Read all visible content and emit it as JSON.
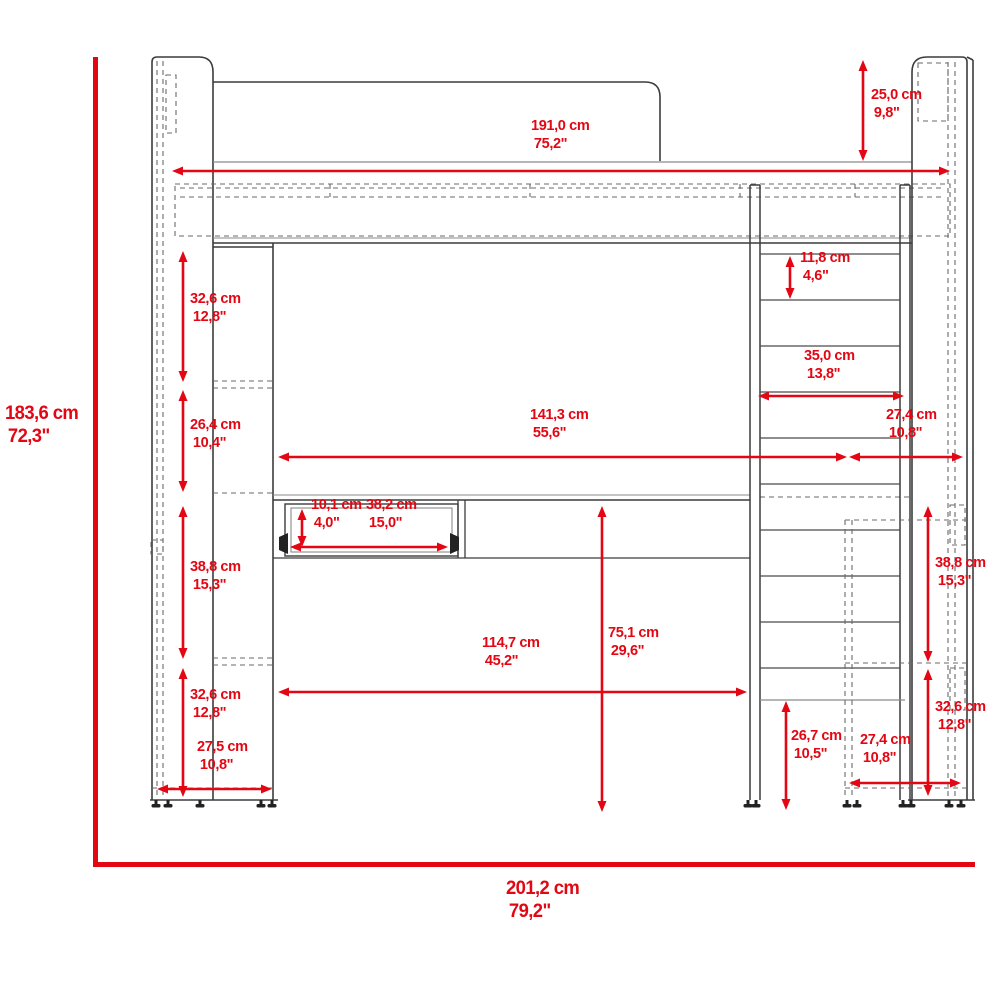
{
  "diagram": {
    "type": "furniture-dimension-drawing",
    "subject": "loft bed with desk, wardrobe tower, drawer and ladder — front elevation",
    "accent_color": "#e30613",
    "line_color": "#3c3c3c",
    "units": [
      "cm",
      "inch"
    ]
  },
  "overall": {
    "height": {
      "cm": "183,6 cm",
      "inch": "72,3\""
    },
    "width": {
      "cm": "201,2 cm",
      "inch": "79,2\""
    }
  },
  "dimensions": {
    "bed_length": {
      "cm": "191,0 cm",
      "inch": "75,2\""
    },
    "headboard_height": {
      "cm": "25,0 cm",
      "inch": "9,8\""
    },
    "ladder_rung_spacing": {
      "cm": "11,8 cm",
      "inch": "4,6\""
    },
    "ladder_width": {
      "cm": "35,0 cm",
      "inch": "13,8\""
    },
    "underbed_clear_width": {
      "cm": "141,3 cm",
      "inch": "55,6\""
    },
    "right_depth_upper": {
      "cm": "27,4 cm",
      "inch": "10,8\""
    },
    "left_shelf_upper": {
      "cm": "32,6 cm",
      "inch": "12,8\""
    },
    "left_shelf_middle": {
      "cm": "26,4 cm",
      "inch": "10,4\""
    },
    "drawer_height": {
      "cm": "10,1 cm",
      "inch": "4,0\""
    },
    "drawer_width": {
      "cm": "38,2 cm",
      "inch": "15,0\""
    },
    "left_shelf_lower": {
      "cm": "38,8 cm",
      "inch": "15,3\""
    },
    "desk_width": {
      "cm": "114,7 cm",
      "inch": "45,2\""
    },
    "desk_height": {
      "cm": "75,1 cm",
      "inch": "29,6\""
    },
    "left_shelf_bottom": {
      "cm": "32,6 cm",
      "inch": "12,8\""
    },
    "left_depth": {
      "cm": "27,5 cm",
      "inch": "10,8\""
    },
    "under_shelf_right": {
      "cm": "26,7 cm",
      "inch": "10,5\""
    },
    "right_depth_lower": {
      "cm": "27,4 cm",
      "inch": "10,8\""
    },
    "right_shelf_upper": {
      "cm": "38,8 cm",
      "inch": "15,3\""
    },
    "right_shelf_lower": {
      "cm": "32,6 cm",
      "inch": "12,8\""
    }
  }
}
